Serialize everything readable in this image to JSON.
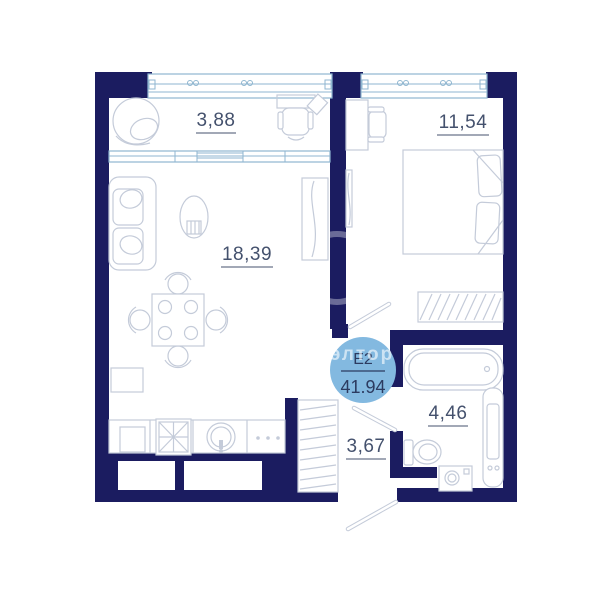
{
  "page": {
    "background": "#ffffff"
  },
  "plan": {
    "badge": {
      "unit_type": "Е2",
      "total_area": "41.94",
      "watermark_text": "элтор"
    },
    "rooms": [
      {
        "name": "balcony",
        "area_label": "3,88"
      },
      {
        "name": "living-kitchen",
        "area_label": "18,39"
      },
      {
        "name": "bedroom",
        "area_label": "11,54"
      },
      {
        "name": "bathroom",
        "area_label": "4,46"
      },
      {
        "name": "hallway",
        "area_label": "3,67"
      }
    ],
    "colors": {
      "walls": "#1b1c60",
      "window_frame": "#8fb6d0",
      "furniture_outline": "#c4cbd9",
      "area_label_text": "#44516d",
      "badge_fill": "#83b9e0",
      "badge_text": "#2c3b60",
      "watermark": "rgba(255,255,255,0.6)"
    }
  }
}
